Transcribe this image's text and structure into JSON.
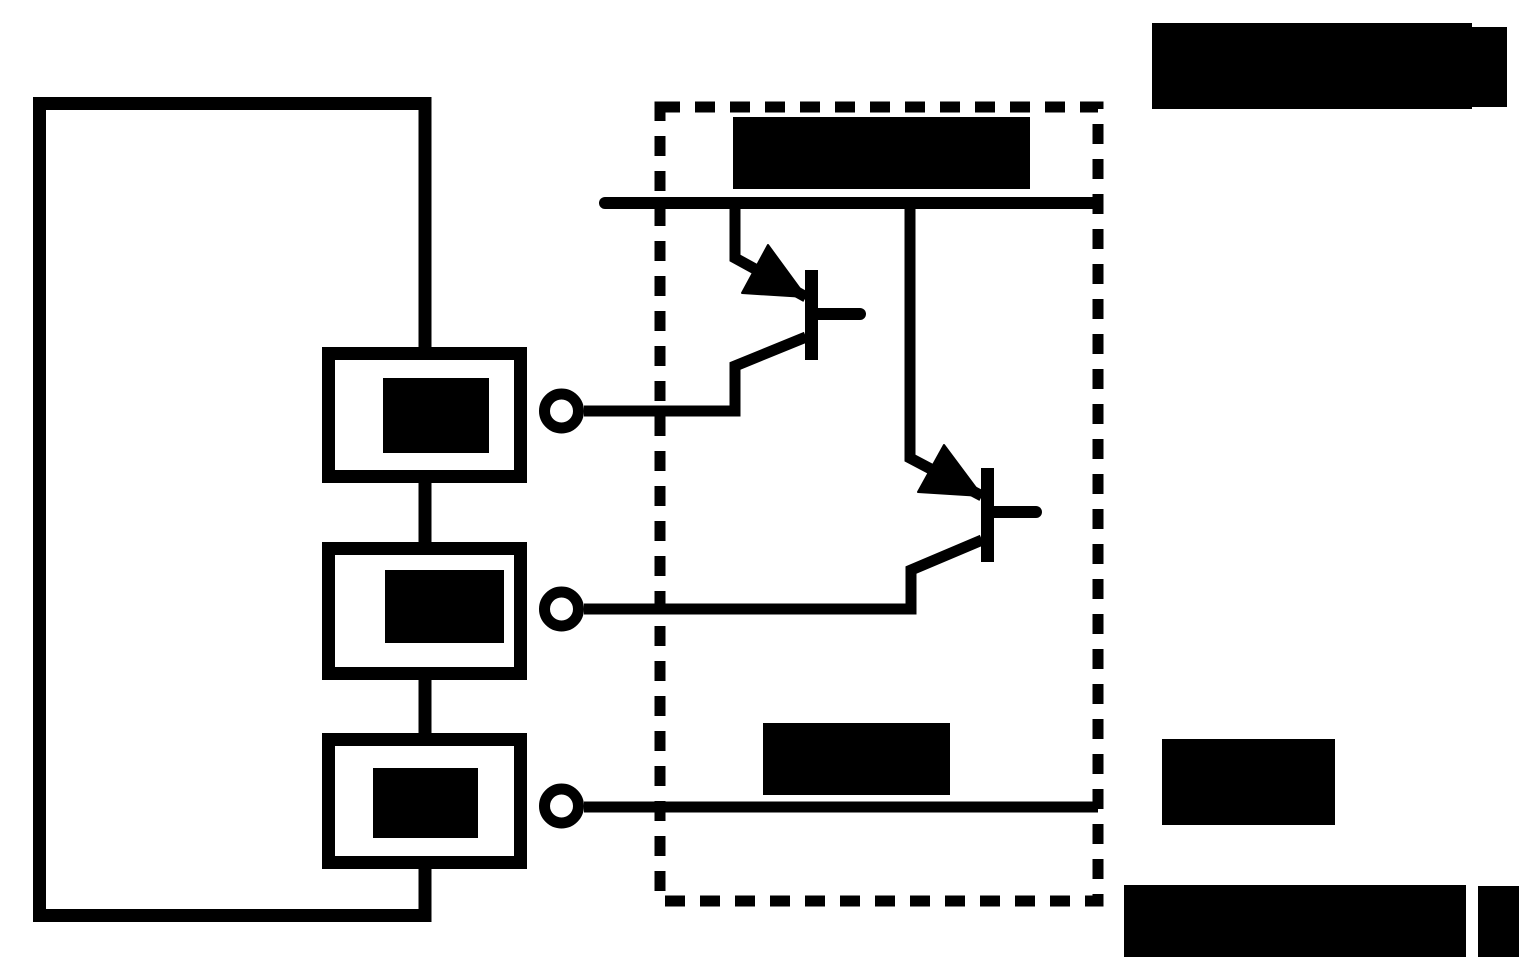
{
  "canvas": {
    "width": 1538,
    "height": 979,
    "background": "#ffffff",
    "ink": "#000000"
  },
  "figure": {
    "description": "circuit-schematic-with-redacted-labels",
    "visible_text": []
  },
  "diagram": {
    "elements": [
      {
        "name": "device-outline",
        "kind": "path",
        "d": "M 425 352 L 425 103.5 L 39.5 103.5 L 39.5 915.5 L 425 915.5 L 425 864",
        "sw": 13
      },
      {
        "name": "box-connector-1",
        "kind": "path",
        "d": "M 425 475 L 425 552",
        "sw": 13
      },
      {
        "name": "box-connector-2",
        "kind": "path",
        "d": "M 425 673 L 425 746",
        "sw": 13
      },
      {
        "name": "element-box-1",
        "kind": "rect",
        "x": 328.5,
        "y": 353.5,
        "w": 192,
        "h": 123,
        "sw": 13
      },
      {
        "name": "element-box-2",
        "kind": "rect",
        "x": 328.5,
        "y": 548.5,
        "w": 192,
        "h": 125,
        "sw": 13
      },
      {
        "name": "element-box-3",
        "kind": "rect",
        "x": 328.5,
        "y": 739.5,
        "w": 192,
        "h": 123,
        "sw": 13
      },
      {
        "name": "redacted-label-box-1",
        "kind": "rect",
        "x": 383,
        "y": 378,
        "w": 106,
        "h": 75
      },
      {
        "name": "redacted-label-box-2",
        "kind": "rect",
        "x": 385,
        "y": 570,
        "w": 119,
        "h": 73
      },
      {
        "name": "redacted-label-box-3",
        "kind": "rect",
        "x": 373,
        "y": 768,
        "w": 105,
        "h": 70
      },
      {
        "name": "ic-dashed-boundary",
        "kind": "rect",
        "x": 660,
        "y": 107,
        "w": 438,
        "h": 794,
        "sw": 11,
        "dash": "20 15"
      },
      {
        "name": "supply-rail",
        "kind": "path",
        "d": "M 605 203 L 1097 203",
        "sw": 12,
        "cap": "round"
      },
      {
        "name": "q1-emitter-lead",
        "kind": "path",
        "d": "M 735 203 L 735 258 L 806 297",
        "sw": 11
      },
      {
        "name": "q1-emitter-arrow",
        "kind": "polygon",
        "points": "806,297 742,293 768,245"
      },
      {
        "name": "q1-base-bar",
        "kind": "rect",
        "x": 805,
        "y": 270,
        "w": 13,
        "h": 90
      },
      {
        "name": "q1-base-stub",
        "kind": "path",
        "d": "M 816 314 L 860 314",
        "sw": 12,
        "cap": "round"
      },
      {
        "name": "wire-q1-to-terminal-1",
        "kind": "path",
        "d": "M 806 337 L 735 366 L 735 411 L 584 411",
        "sw": 11
      },
      {
        "name": "q2-emitter-lead",
        "kind": "path",
        "d": "M 910 203 L 910 458 L 982 496",
        "sw": 11
      },
      {
        "name": "q2-emitter-arrow",
        "kind": "polygon",
        "points": "982,496 918,492 944,445"
      },
      {
        "name": "q2-base-bar",
        "kind": "rect",
        "x": 981,
        "y": 468,
        "w": 13,
        "h": 94
      },
      {
        "name": "q2-base-stub",
        "kind": "path",
        "d": "M 992 512 L 1036 512",
        "sw": 12,
        "cap": "round"
      },
      {
        "name": "wire-q2-to-terminal-2",
        "kind": "path",
        "d": "M 982 540 L 911 570 L 911 609 L 584 609",
        "sw": 11
      },
      {
        "name": "wire-terminal-3",
        "kind": "path",
        "d": "M 584 807 L 1098 807",
        "sw": 11
      },
      {
        "name": "terminal-1",
        "kind": "circle",
        "cx": 561.5,
        "cy": 411,
        "r": 17,
        "sw": 11
      },
      {
        "name": "terminal-2",
        "kind": "circle",
        "cx": 561.5,
        "cy": 609,
        "r": 17,
        "sw": 11
      },
      {
        "name": "terminal-3",
        "kind": "circle",
        "cx": 561.5,
        "cy": 806,
        "r": 17,
        "sw": 11
      },
      {
        "name": "redacted-label-ic-top",
        "kind": "rect",
        "x": 733,
        "y": 117,
        "w": 297,
        "h": 72
      },
      {
        "name": "redacted-label-ic-bottom",
        "kind": "rect",
        "x": 763,
        "y": 723,
        "w": 187,
        "h": 72
      },
      {
        "name": "redacted-label-top-right",
        "kind": "rect",
        "x": 1152,
        "y": 23,
        "w": 320,
        "h": 86
      },
      {
        "name": "redacted-label-top-right-suffix",
        "kind": "rect",
        "x": 1472,
        "y": 27,
        "w": 35,
        "h": 80
      },
      {
        "name": "redacted-label-mid-right",
        "kind": "rect",
        "x": 1162,
        "y": 739,
        "w": 173,
        "h": 86
      },
      {
        "name": "redacted-label-bottom-right",
        "kind": "rect",
        "x": 1124,
        "y": 885,
        "w": 342,
        "h": 72
      },
      {
        "name": "redacted-label-bottom-right-suffix",
        "kind": "rect",
        "x": 1478,
        "y": 886,
        "w": 41,
        "h": 71
      }
    ]
  }
}
